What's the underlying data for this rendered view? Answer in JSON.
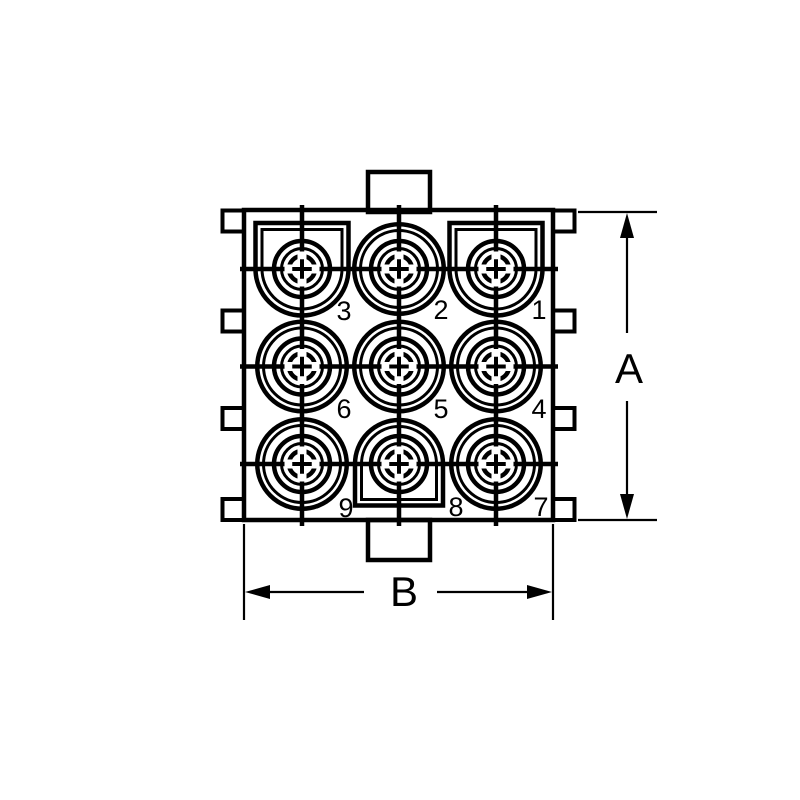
{
  "colors": {
    "line": "#000000",
    "background": "#ffffff"
  },
  "connector": {
    "pins": [
      {
        "label": "1",
        "key": "keyed-top"
      },
      {
        "label": "2",
        "key": "round"
      },
      {
        "label": "3",
        "key": "keyed-top"
      },
      {
        "label": "4",
        "key": "round"
      },
      {
        "label": "5",
        "key": "round"
      },
      {
        "label": "6",
        "key": "round"
      },
      {
        "label": "7",
        "key": "round"
      },
      {
        "label": "8",
        "key": "keyed-bottom"
      },
      {
        "label": "9",
        "key": "round"
      }
    ],
    "dimensions": {
      "height_label": "A",
      "width_label": "B"
    }
  }
}
